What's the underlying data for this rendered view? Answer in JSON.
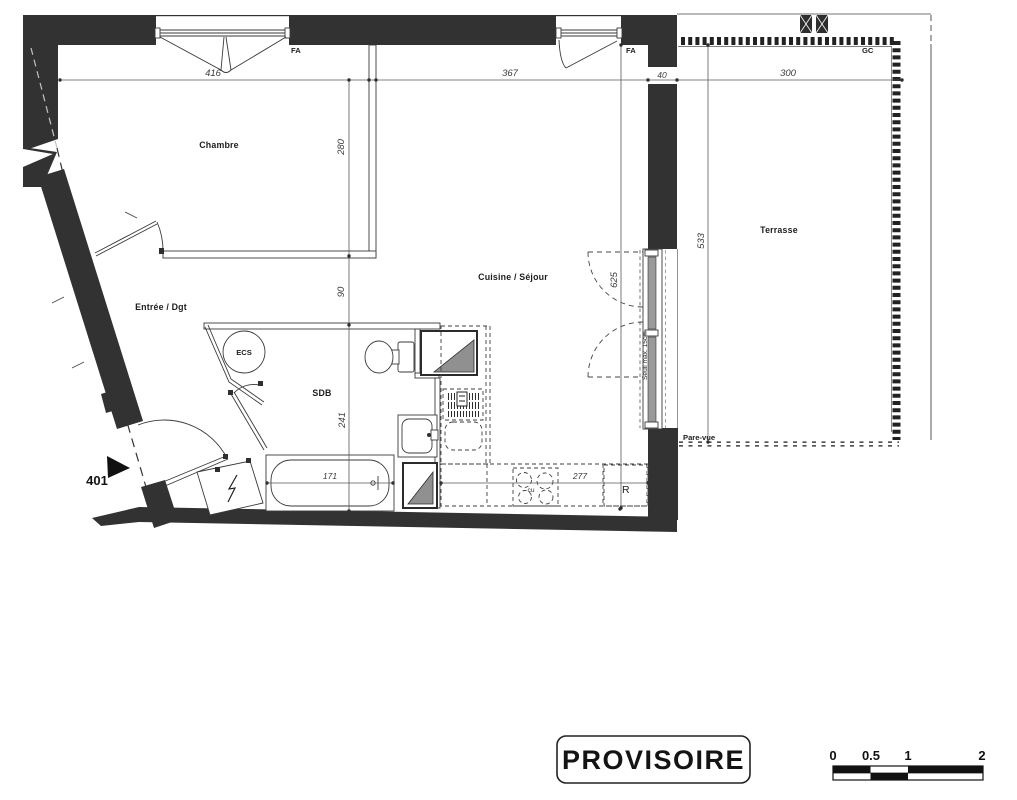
{
  "unit": {
    "number": "401"
  },
  "rooms": {
    "bedroom": "Chambre",
    "living_kitchen": "Cuisine / Séjour",
    "entry": "Entrée / Dgt",
    "bathroom": "SDB",
    "terrace": "Terrasse",
    "water_heater": "ECS"
  },
  "openings": {
    "bedroom_window": "FA",
    "living_window": "FA",
    "terrace_guardrail": "GC",
    "privacy_screen": "Pare-vue",
    "threshold_note": "Seuil max. 15cm"
  },
  "appliances": {
    "fridge": "R",
    "cooktop": "cu"
  },
  "dimensions_cm": {
    "bedroom_width": "416",
    "living_width": "367",
    "wall_thickness": "40",
    "terrace_width": "300",
    "bedroom_depth": "280",
    "hall_depth": "90",
    "bathroom_depth": "241",
    "living_depth": "625",
    "terrace_depth": "533",
    "bathtub_length": "171",
    "kitchen_run": "277"
  },
  "stamp": {
    "text": "PROVISOIRE"
  },
  "scale_bar": {
    "ticks": [
      "0",
      "0.5",
      "1",
      "2"
    ]
  }
}
